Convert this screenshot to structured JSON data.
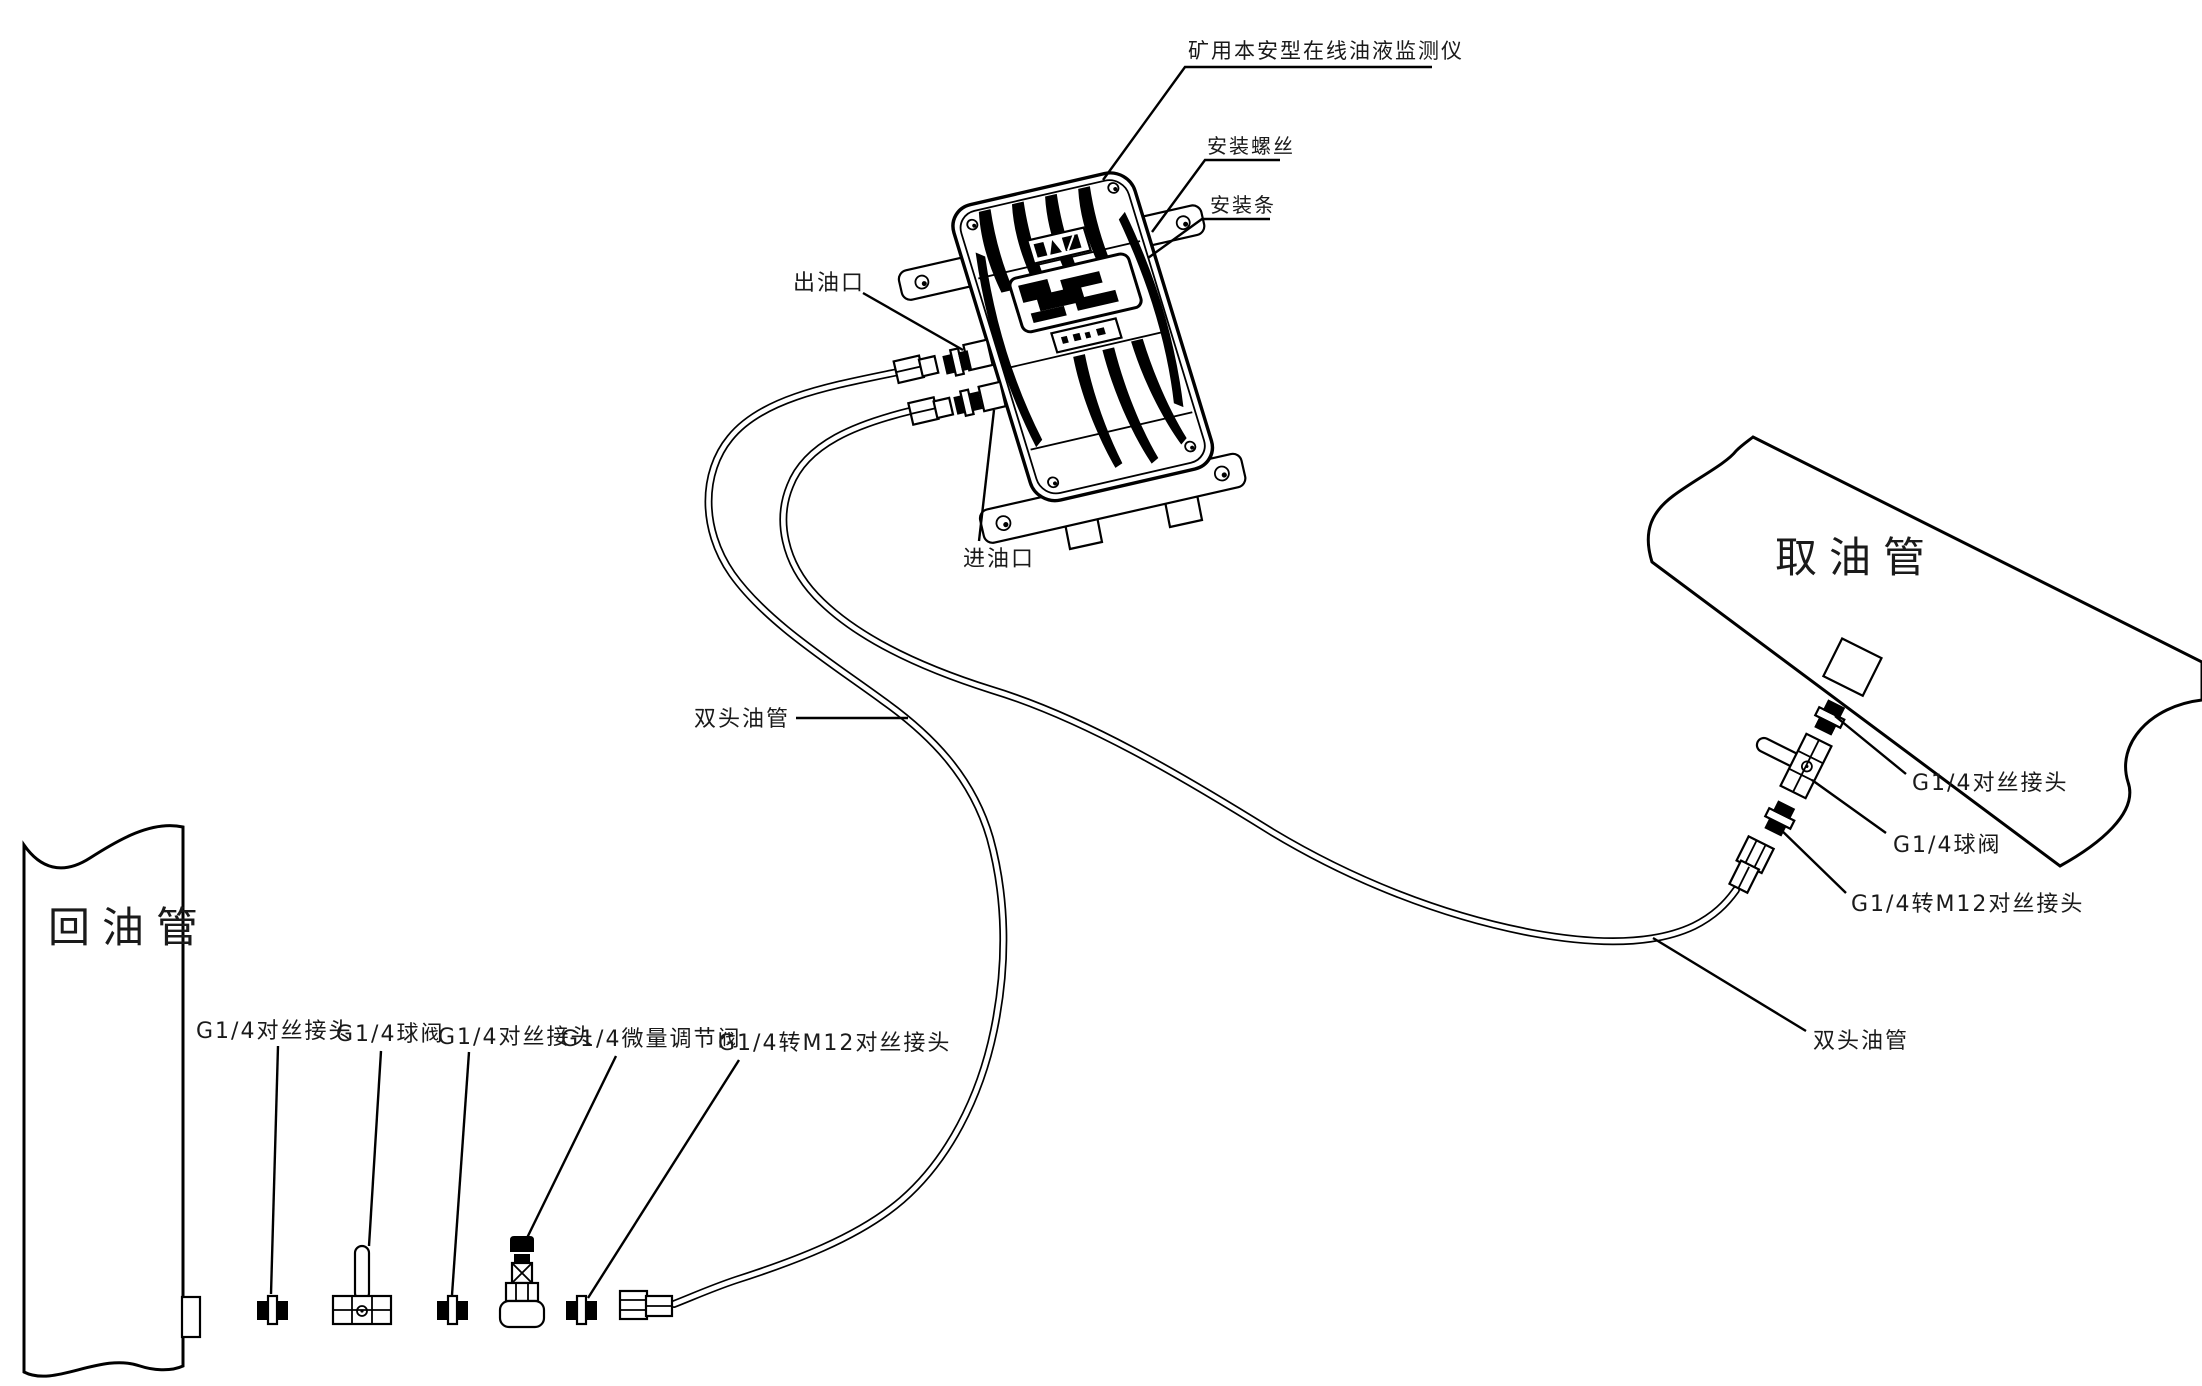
{
  "diagram": {
    "title": "矿用本安型在线油液监测仪",
    "labels": {
      "mounting_screw": "安装螺丝",
      "mounting_bar": "安装条",
      "oil_outlet": "出油口",
      "oil_inlet": "进油口",
      "tube_left": "双头油管",
      "tube_right": "双头油管",
      "sampling_pipe": "取油管",
      "return_pipe": "回油管",
      "right_fittings": [
        "G1/4对丝接头",
        "G1/4球阀",
        "G1/4转M12对丝接头"
      ],
      "bottom_fittings": [
        "G1/4对丝接头",
        "G1/4球阀",
        "G1/4对丝接头",
        "G1/4微量调节阀",
        "G1/4转M12对丝接头"
      ]
    },
    "colors": {
      "line": "#000000",
      "background": "#ffffff"
    }
  }
}
